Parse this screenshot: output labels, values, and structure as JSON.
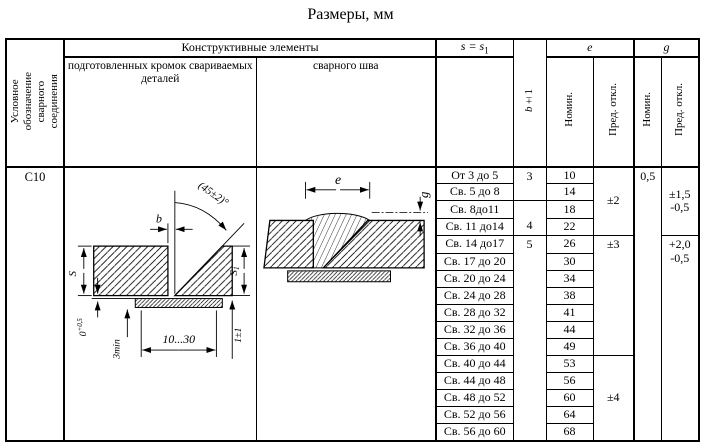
{
  "title": "Размеры, мм",
  "designation_header": {
    "lines": [
      "Условное",
      "обозначение",
      "сварного",
      "соединения"
    ]
  },
  "header": {
    "constructive": "Конструктивные элементы",
    "prepared_edges": "подготовленных кромок свариваемых деталей",
    "weld_seam": "сварного шва",
    "s": "s = s",
    "s_sub": "1",
    "b": "b",
    "b_tol": "±1",
    "e": "e",
    "g": "g",
    "nominal": "Номин.",
    "deviation": "Пред. откл."
  },
  "designation_value": "С10",
  "rows": [
    {
      "s": "От 3 до 5",
      "e": "10"
    },
    {
      "s": "Св. 5 до 8",
      "e": "14"
    },
    {
      "s": "Св. 8до11",
      "e": "18"
    },
    {
      "s": "Св. 11 до14",
      "e": "22"
    },
    {
      "s": "Св. 14 до17",
      "e": "26"
    },
    {
      "s": "Св. 17 до 20",
      "e": "30"
    },
    {
      "s": "Св. 20 до 24",
      "e": "34"
    },
    {
      "s": "Св. 24 до 28",
      "e": "38"
    },
    {
      "s": "Св. 28 до 32",
      "e": "41"
    },
    {
      "s": "Св. 32 до 36",
      "e": "44"
    },
    {
      "s": "Св. 36 до 40",
      "e": "49"
    },
    {
      "s": "Св. 40 до 44",
      "e": "53"
    },
    {
      "s": "Св. 44 до 48",
      "e": "56"
    },
    {
      "s": "Св. 48 до 52",
      "e": "60"
    },
    {
      "s": "Св. 52 до 56",
      "e": "64"
    },
    {
      "s": "Св. 56 до 60",
      "e": "68"
    }
  ],
  "b_groups": [
    "3",
    "4",
    "5"
  ],
  "e_tolerances": [
    "±2",
    "±3",
    "±4"
  ],
  "g_nominal": "0,5",
  "g_tolerances": [
    {
      "line1": "±1,5",
      "line2": "-0,5"
    },
    {
      "line1": "+2,0",
      "line2": "-0,5"
    }
  ],
  "diagram_edges": {
    "angle": "(45±2)°",
    "b": "b",
    "s": "S",
    "s1": "S",
    "s1_sub": "1",
    "zero": "0",
    "zero_sup": "+0,5",
    "min3": "3min",
    "width": "10...30",
    "one": "1±1"
  },
  "diagram_seam": {
    "e": "e",
    "g": "g"
  }
}
